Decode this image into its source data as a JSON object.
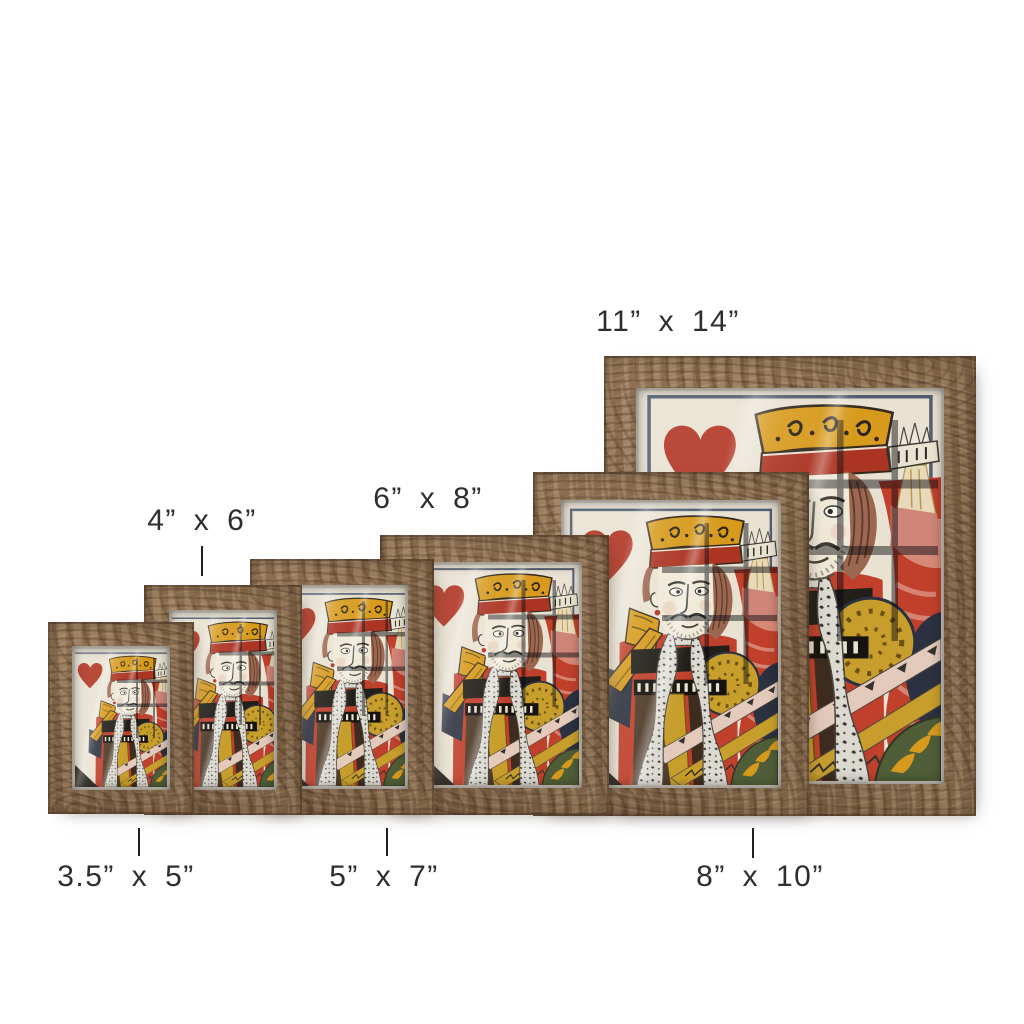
{
  "page": {
    "background": "#ffffff",
    "description": "Wood picture frame size comparison product photo"
  },
  "artwork": {
    "subject": "king-of-hearts-vintage-playing-card",
    "colors": {
      "card_background": "#e9e2d2",
      "heart_red": "#b13524",
      "crown_gold": "#d79a1c",
      "robe_red": "#c0402c",
      "ruffle_pink": "#d9917f",
      "shadow_navy": "#2b3140",
      "ermine_white": "#dbd9d0",
      "ink_dark": "#3b3a33",
      "wood_brown": "#8a6c4e"
    }
  },
  "frames": [
    {
      "size": "3.5x5",
      "x": 48,
      "y": 622,
      "w": 146,
      "h": 192,
      "z": 6,
      "border": 24
    },
    {
      "size": "4x6",
      "x": 144,
      "y": 585,
      "w": 158,
      "h": 230,
      "z": 5,
      "border": 25
    },
    {
      "size": "5x7",
      "x": 250,
      "y": 559,
      "w": 184,
      "h": 256,
      "z": 4,
      "border": 26
    },
    {
      "size": "6x8",
      "x": 380,
      "y": 535,
      "w": 229,
      "h": 280,
      "z": 3,
      "border": 27
    },
    {
      "size": "8x10",
      "x": 533,
      "y": 472,
      "w": 276,
      "h": 344,
      "z": 2,
      "border": 28
    },
    {
      "size": "11x14",
      "x": 604,
      "y": 356,
      "w": 372,
      "h": 460,
      "z": 1,
      "border": 32
    }
  ],
  "size_labels": [
    {
      "id": "3.5x5",
      "text": "3.5”  x  5”",
      "cx": 126,
      "cy": 877,
      "tick": {
        "x": 139,
        "y1": 828,
        "y2": 856
      }
    },
    {
      "id": "5x7",
      "text": "5”  x  7”",
      "cx": 384,
      "cy": 877,
      "tick": {
        "x": 387,
        "y1": 828,
        "y2": 856
      }
    },
    {
      "id": "8x10",
      "text": "8”  x  10”",
      "cx": 760,
      "cy": 877,
      "tick": {
        "x": 753,
        "y1": 828,
        "y2": 858
      }
    },
    {
      "id": "4x6",
      "text": "4”  x  6”",
      "cx": 202,
      "cy": 521,
      "tick": {
        "x": 202,
        "y1": 546,
        "y2": 576
      }
    },
    {
      "id": "6x8",
      "text": "6”  x  8”",
      "cx": 428,
      "cy": 499,
      "tick": null
    },
    {
      "id": "11x14",
      "text": "11”  x  14”",
      "cx": 668,
      "cy": 322,
      "tick": null
    }
  ]
}
